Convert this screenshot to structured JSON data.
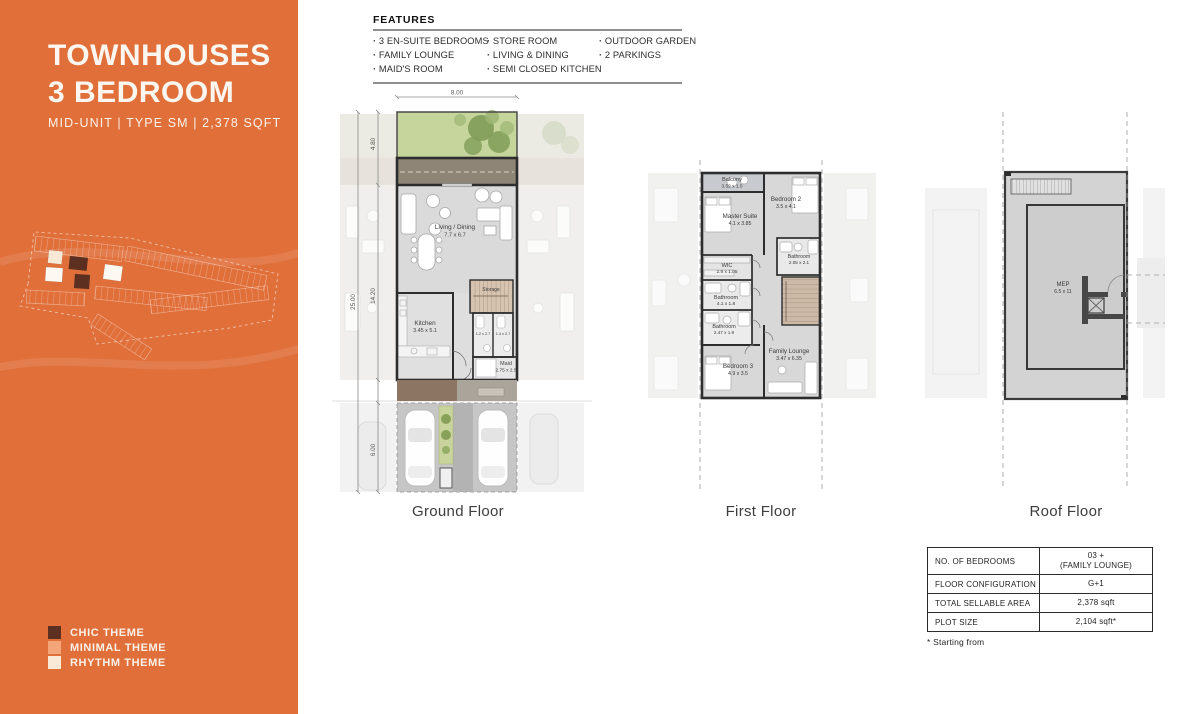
{
  "sidebar": {
    "accent_color": "#e06f3a",
    "title_line1": "TOWNHOUSES",
    "title_line2": "3 BEDROOM",
    "subtitle": "MID-UNIT  |  TYPE SM | 2,378 SQFT",
    "themes": [
      {
        "label": "CHIC THEME",
        "color": "#5d2f21"
      },
      {
        "label": "MINIMAL THEME",
        "color": "#f2a679"
      },
      {
        "label": "RHYTHM THEME",
        "color": "#f9ead8"
      }
    ]
  },
  "features": {
    "title": "FEATURES",
    "columns": [
      {
        "items": [
          "3 EN-SUITE BEDROOMS",
          "FAMILY LOUNGE",
          "MAID'S ROOM"
        ]
      },
      {
        "items": [
          "STORE ROOM",
          "LIVING & DINING",
          "SEMI CLOSED KITCHEN"
        ]
      },
      {
        "items": [
          "OUTDOOR GARDEN",
          "2 PARKINGS"
        ]
      }
    ]
  },
  "floors": {
    "ground": {
      "label": "Ground Floor",
      "dims": {
        "width": "8.00",
        "garden": "4.80",
        "total": "25.00",
        "house": "14.20",
        "driveway": "6.00"
      },
      "rooms": {
        "living": {
          "name": "Living / Dining",
          "size": "7.7 x 6.7"
        },
        "kitchen": {
          "name": "Kitchen",
          "size": "3.45 x 5.1"
        },
        "storage": {
          "name": "Storage"
        },
        "maid": {
          "name": "Maid",
          "size": "2.75 x 2.5"
        },
        "wc1": {
          "size": "1.2 x 2.7"
        },
        "wc2": {
          "size": "1.4 x 2.7"
        }
      }
    },
    "first": {
      "label": "First Floor",
      "rooms": {
        "balcony": {
          "name": "Balcony",
          "size": "3.52 x 1.5"
        },
        "master": {
          "name": "Master Suite",
          "size": "4.1 x 3.85"
        },
        "bedroom2": {
          "name": "Bedroom 2",
          "size": "3.5 x 4.1"
        },
        "bath_ensuite": {
          "name": "Bathroom",
          "size": "2.05 x 2.1"
        },
        "wic": {
          "name": "WIC",
          "size": "2.9 x 1.05"
        },
        "bath_master": {
          "name": "Bathroom",
          "size": "4.1 x 1.8"
        },
        "bath_shared": {
          "name": "Bathroom",
          "size": "2.47 x 1.9"
        },
        "bedroom3": {
          "name": "Bedroom 3",
          "size": "4.9 x 3.5"
        },
        "family_lounge": {
          "name": "Family Lounge",
          "size": "3.47 x 6.35"
        }
      }
    },
    "roof": {
      "label": "Roof Floor",
      "rooms": {
        "mep": {
          "name": "MEP",
          "size": "6.5 x 11"
        }
      }
    }
  },
  "spec_table": {
    "rows": [
      {
        "label": "NO. OF BEDROOMS",
        "value": "03 +",
        "value2": "(FAMILY LOUNGE)"
      },
      {
        "label": "FLOOR CONFIGURATION",
        "value": "G+1"
      },
      {
        "label": "TOTAL SELLABLE AREA",
        "value": "2,378 sqft"
      },
      {
        "label": "PLOT SIZE",
        "value": "2,104 sqft*"
      }
    ],
    "footnote": "* Starting from"
  }
}
